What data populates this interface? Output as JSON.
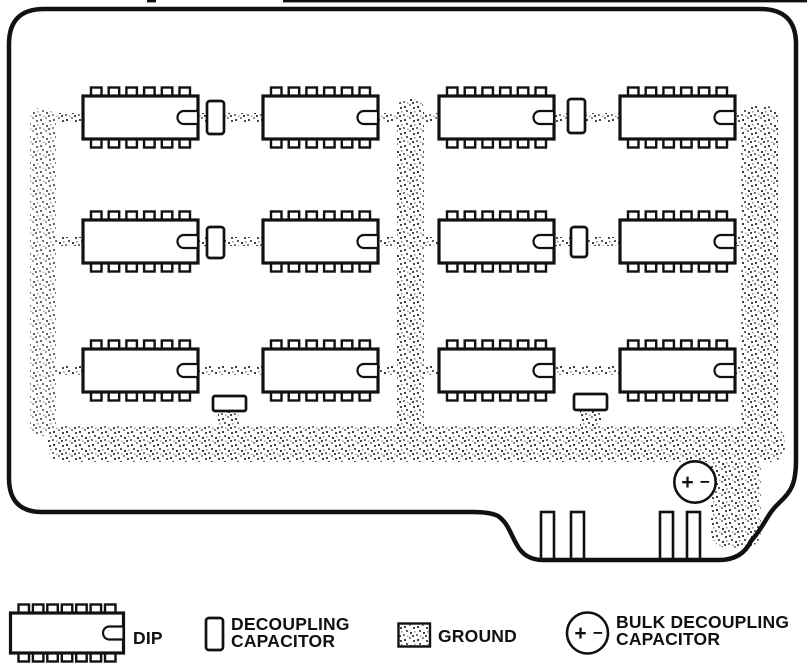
{
  "title": "Printed circuit board decoupling layout diagram",
  "colors": {
    "ink": "#111111",
    "paper": "#ffffff",
    "stipple_dark": "#3c3c3c",
    "stipple_mid": "#6e6e6e",
    "stipple_light": "#a8a8a8"
  },
  "board": {
    "dips": {
      "cols_x": [
        83,
        263,
        439,
        620
      ],
      "rows_y": [
        96,
        220,
        349
      ],
      "w": 115,
      "h": 43,
      "pins_per_side": 6
    },
    "vertical_caps": [
      {
        "x": 207,
        "y": 101,
        "w": 17,
        "h": 33
      },
      {
        "x": 568,
        "y": 99,
        "w": 17,
        "h": 34
      },
      {
        "x": 207,
        "y": 227,
        "w": 17,
        "h": 31
      },
      {
        "x": 571,
        "y": 227,
        "w": 16,
        "h": 30
      }
    ],
    "horizontal_caps": [
      {
        "x": 213,
        "y": 396,
        "w": 33,
        "h": 15
      },
      {
        "x": 574,
        "y": 394,
        "w": 33,
        "h": 16
      }
    ],
    "ground": {
      "left_strip": {
        "x": 30,
        "y": 108,
        "w": 26,
        "h": 328
      },
      "mid_strip": {
        "x": 397,
        "y": 99,
        "w": 27,
        "h": 352
      },
      "right_strip": {
        "x": 741,
        "y": 106,
        "w": 37,
        "h": 350
      },
      "bottom_band": {
        "x": 48,
        "y": 426,
        "w": 737,
        "h": 36
      },
      "corner_blob": {
        "x": 711,
        "y": 450,
        "w": 50,
        "h": 98
      },
      "row_trace_y": [
        113,
        237,
        366
      ],
      "trace_h": 9,
      "trace_segments_x": [
        [
          56,
          30
        ],
        [
          196,
          68
        ],
        [
          377,
          22
        ],
        [
          423,
          18
        ],
        [
          552,
          70
        ],
        [
          733,
          11
        ]
      ],
      "cap_drops": [
        {
          "x": 218,
          "y": 405,
          "w": 21,
          "h": 27
        },
        {
          "x": 580,
          "y": 404,
          "w": 21,
          "h": 28
        }
      ]
    },
    "fingers": {
      "xs": [
        541,
        571,
        660,
        687
      ],
      "y": 512,
      "w": 13,
      "h": 47
    },
    "bulk_capacitor": {
      "cx": 695,
      "cy": 482,
      "r": 20.7,
      "plus": "+",
      "minus": "−"
    }
  },
  "legend": {
    "dip": {
      "label": "DIP",
      "symbol": {
        "x": 10.5,
        "y": 613,
        "w": 113,
        "h": 40,
        "pins_per_side": 7
      }
    },
    "decoupling": {
      "line1": "DECOUPLING",
      "line2": "CAPACITOR"
    },
    "ground": {
      "label": "GROUND"
    },
    "bulk": {
      "line1": "BULK DECOUPLING",
      "line2": "CAPACITOR",
      "plus": "+",
      "minus": "−"
    }
  }
}
